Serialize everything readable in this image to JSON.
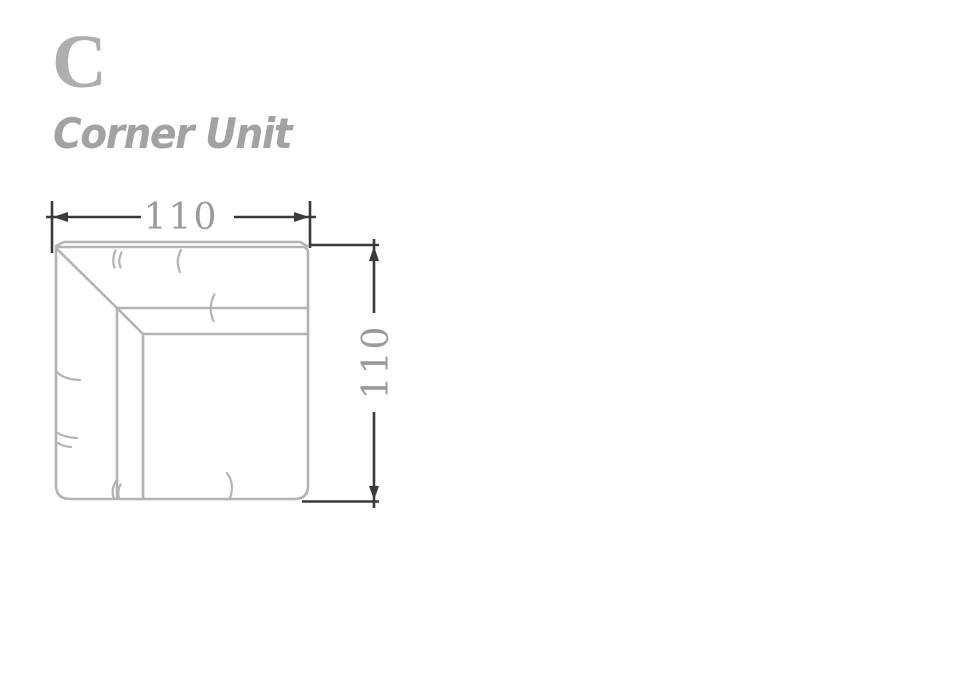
{
  "header": {
    "unit_code": "C",
    "unit_name": "Corner Unit"
  },
  "diagram": {
    "width_label": "110",
    "height_label": "110"
  },
  "colors": {
    "background": "#ffffff",
    "unit_code_text": "#aeaeae",
    "unit_name_text": "#a2a2a2",
    "outline": "#b3b3b5",
    "dimension_line": "#3a3a3a",
    "dimension_label": "#9a9a9a"
  }
}
